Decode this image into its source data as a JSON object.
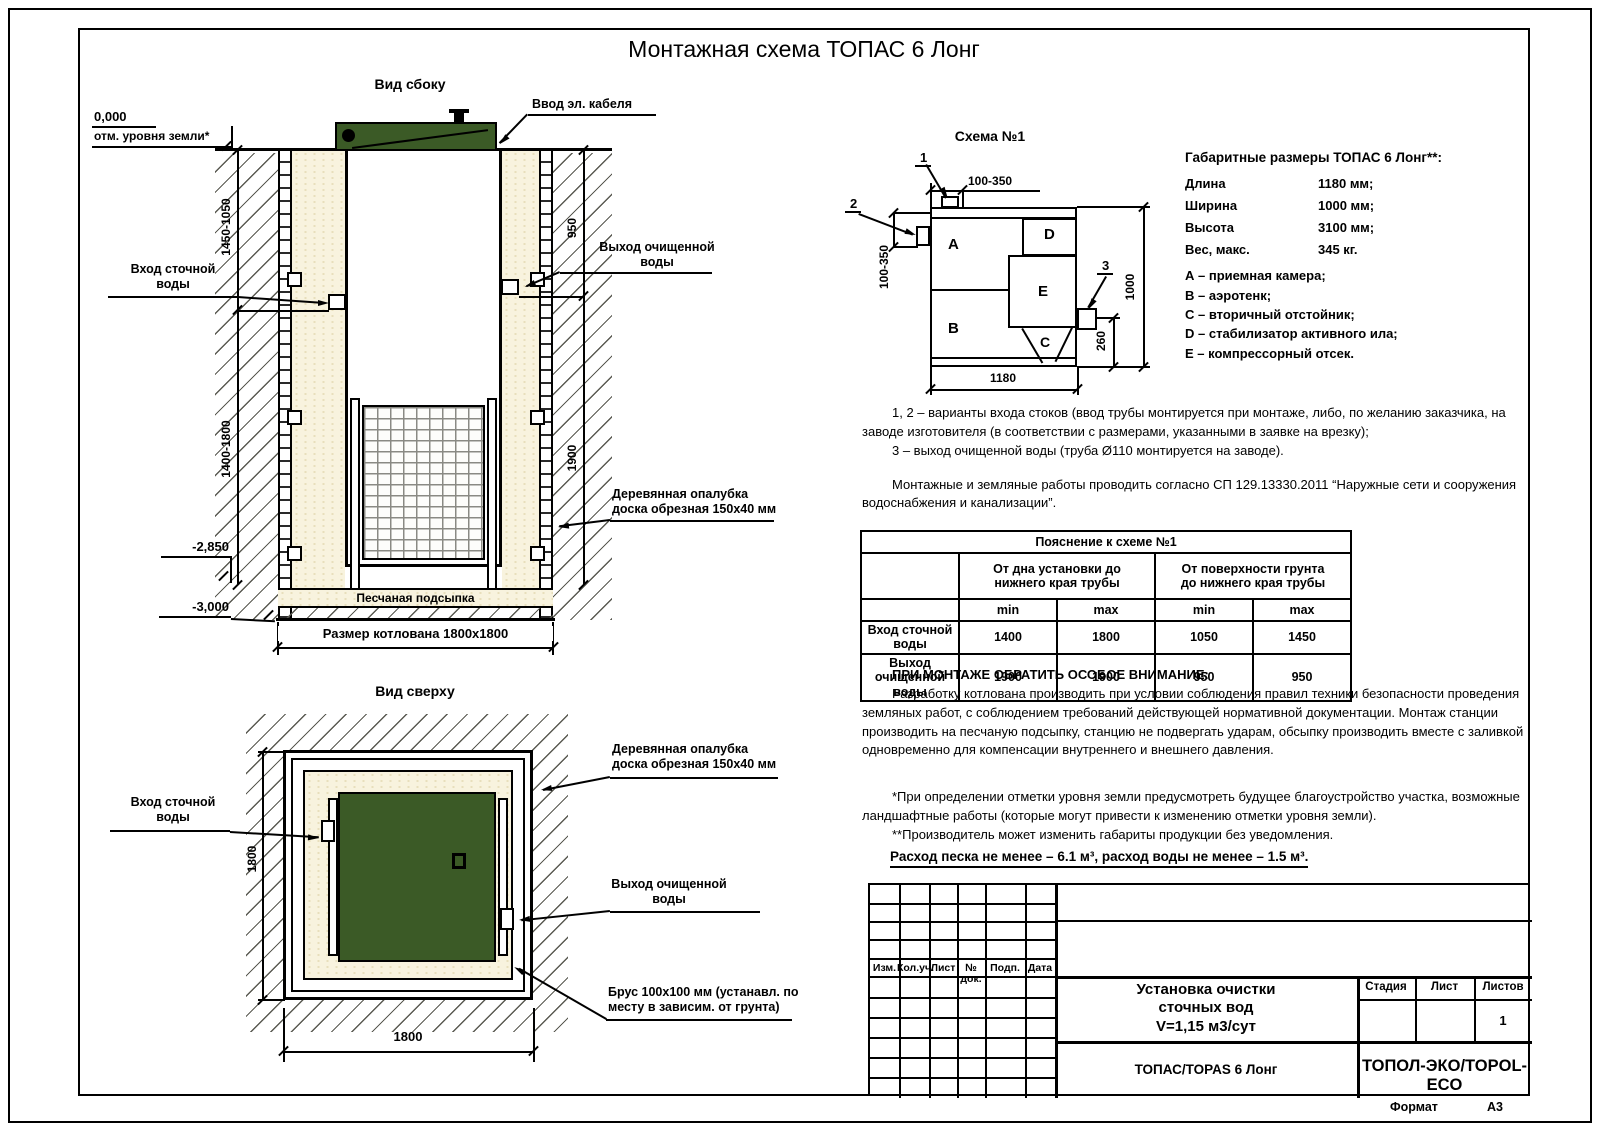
{
  "title": "Монтажная схема ТОПАС 6 Лонг",
  "colors": {
    "tank_green": "#3b5a26",
    "sand_fill": "#f8f3de"
  },
  "side_view": {
    "label": "Вид сбоку",
    "level_zero": "0,000",
    "ground_note": "отм. уровня земли*",
    "cable_label": "Ввод эл. кабеля",
    "inlet_label": "Вход сточной\nводы",
    "outlet_label": "Выход очищенной\nводы",
    "formwork_label": "Деревянная опалубка\nдоска обрезная 150х40 мм",
    "sand_label": "Песчаная подсыпка",
    "pit_label": "Размер котлована 1800х1800",
    "level_2850": "-2,850",
    "level_3000": "-3,000",
    "dim_left_upper": "1450-1050",
    "dim_left_lower": "1400-1800",
    "dim_right_upper": "950",
    "dim_right_lower": "1900"
  },
  "top_view": {
    "label": "Вид сверху",
    "inlet_label": "Вход сточной\nводы",
    "formwork_label": "Деревянная опалубка\nдоска обрезная 150х40 мм",
    "outlet_label": "Выход очищенной\nводы",
    "beam_label": "Брус 100х100 мм (устанавл. по\nместу в зависим. от грунта)",
    "dim_side": "1800",
    "dim_bottom": "1800"
  },
  "schema": {
    "label": "Схема №1",
    "compartments": {
      "a": "A",
      "b": "B",
      "c": "C",
      "d": "D",
      "e": "E"
    },
    "callout_1": "1",
    "callout_2": "2",
    "callout_3": "3",
    "dim_top": "100-350",
    "dim_left": "100-350",
    "dim_right": "1000",
    "dim_outlet": "260",
    "dim_bottom": "1180"
  },
  "specs": {
    "title": "Габаритные размеры ТОПАС 6 Лонг**:",
    "rows": [
      {
        "label": "Длина",
        "value": "1180 мм;"
      },
      {
        "label": "Ширина",
        "value": "1000 мм;"
      },
      {
        "label": "Высота",
        "value": "3100 мм;"
      },
      {
        "label": "Вес, макс.",
        "value": "345 кг."
      }
    ],
    "legend": [
      "А – приемная камера;",
      "В – аэротенк;",
      "С – вторичный отстойник;",
      "D – стабилизатор активного ила;",
      "Е – компрессорный отсек."
    ]
  },
  "notes": {
    "p1": "1, 2 – варианты входа  стоков (ввод трубы монтируется при монтаже, либо, по желанию заказчика, на заводе изготовителя (в соответствии с размерами, указанными в заявке на врезку);",
    "p2": "3 – выход очищенной воды (труба Ø110 монтируется на заводе).",
    "p3": "Монтажные и земляные работы проводить согласно СП 129.13330.2011 “Наружные сети и сооружения водоснабжения и канализации”."
  },
  "table": {
    "title": "Пояснение к схеме №1",
    "group1": "От дна установки до\nнижнего края трубы",
    "group2": "От поверхности грунта\nдо нижнего края трубы",
    "min": "min",
    "max": "max",
    "rows": [
      {
        "label": "Вход сточной воды",
        "v1": "1400",
        "v2": "1800",
        "v3": "1050",
        "v4": "1450"
      },
      {
        "label": "Выход очищенной воды",
        "v1": "1900",
        "v2": "1900",
        "v3": "950",
        "v4": "950"
      }
    ]
  },
  "attention": {
    "title": "ПРИ МОНТАЖЕ ОБРАТИТЬ ОСОБОЕ ВНИМАНИЕ:",
    "body": "Разработку котлована производить при условии соблюдения правил техники безопасности проведения земляных работ, с соблюдением требований действующей нормативной документации. Монтаж станции производить на песчаную подсыпку, станцию не подвергать ударам, обсыпку производить вместе с заливкой одновременно для компенсации внутреннего и внешнего давления."
  },
  "footnotes": {
    "f1": "*При определении отметки уровня земли предусмотреть будущее благоустройство участка, возможные ландшафтные работы (которые могут привести к изменению отметки уровня земли).",
    "f2": "**Производитель может изменить габариты продукции без уведомления.",
    "consumption": "Расход песка не менее – 6.1 м³, расход воды не менее – 1.5 м³."
  },
  "stamp": {
    "col_headers": [
      "Изм.",
      "Кол.уч.",
      "Лист",
      "№ док.",
      "Подп.",
      "Дата"
    ],
    "doc_title": "Установка очистки\nсточных вод\nV=1,15 м3/сут",
    "stage": "Стадия",
    "sheet": "Лист",
    "sheets": "Листов",
    "sheets_value": "1",
    "model": "ТОПАС/TOPAS 6 Лонг",
    "company": "ТОПОЛ-ЭКО/TOPOL-ECO",
    "format_label": "Формат",
    "format_value": "А3"
  }
}
